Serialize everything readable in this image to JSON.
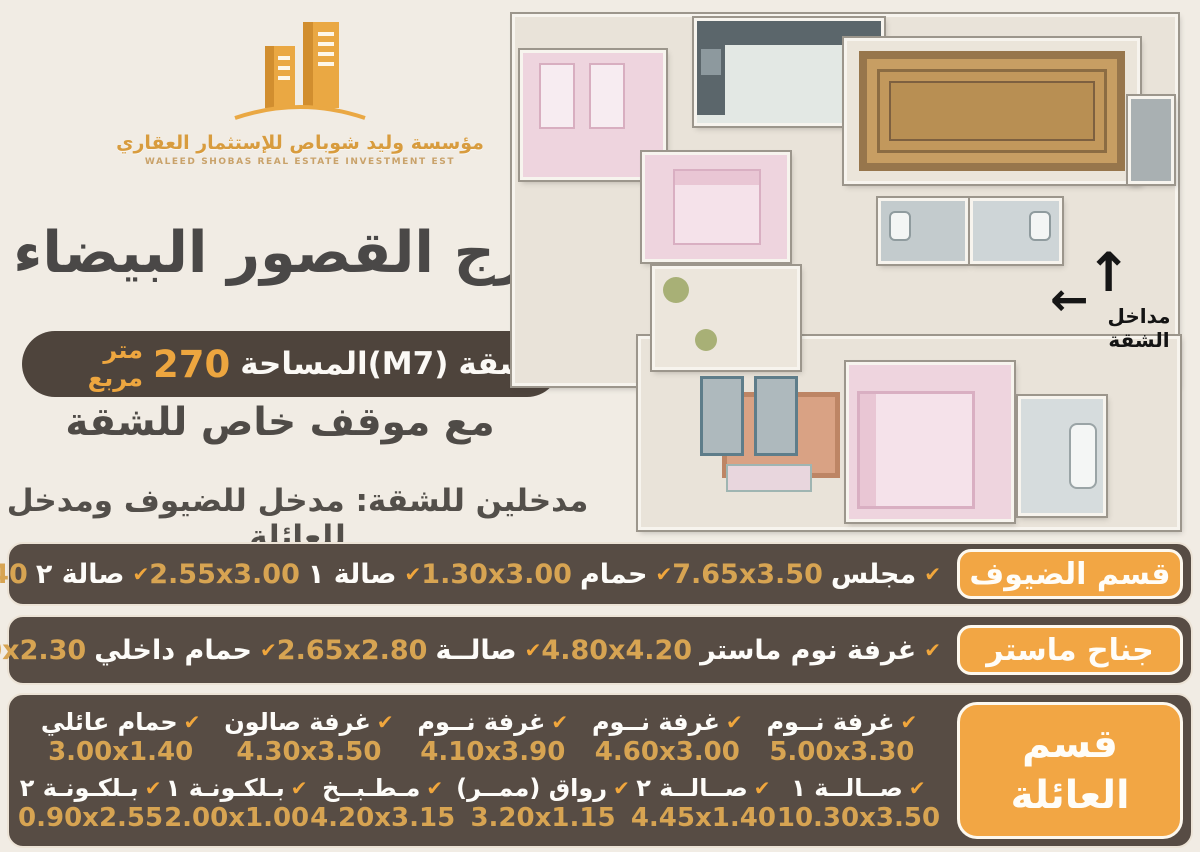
{
  "brand": {
    "name_ar": "مؤسسة وليد شوباص للإستثمار العقاري",
    "name_en": "WALEED SHOBAS REAL ESTATE INVESTMENT EST"
  },
  "header": {
    "title": "برج القصور البيضاء",
    "apartment_label": "شقة",
    "apartment_code": "(M7)",
    "area_label": "المساحة",
    "area_value": "270",
    "area_unit": "متر مربع",
    "parking_note": "مع موقف خاص للشقة",
    "entrances_note": "مدخلين للشقة: مدخل للضيوف ومدخل للعائلة"
  },
  "floor_plan": {
    "entrance_label": "مداخل الشقة"
  },
  "icons": {
    "check": "✔",
    "arrow_up": "↑",
    "arrow_left": "←"
  },
  "colors": {
    "accent_orange": "#f2a644",
    "gold_text": "#d7a452",
    "panel_brown": "#574c44",
    "dark_pill": "#4e443c",
    "title_gray": "#4a4847",
    "page_bg": "#f1ece4"
  },
  "sections": [
    {
      "label": "قسم الضيوف",
      "items": [
        {
          "label": "مجلس",
          "dim": "7.65x3.50"
        },
        {
          "label": "حمام",
          "dim": "1.30x3.00"
        },
        {
          "label": "صالة ١",
          "dim": "2.55x3.00"
        },
        {
          "label": "صالة ٢",
          "dim": "2.25x1.40"
        }
      ]
    },
    {
      "label": "جناح ماستر",
      "items": [
        {
          "label": "غرفة نوم ماستر",
          "dim": "4.80x4.20"
        },
        {
          "label": "صالــة",
          "dim": "2.65x2.80"
        },
        {
          "label": "حمام داخلي",
          "dim": "1.40x2.30"
        }
      ]
    },
    {
      "label": "قسم العائلة",
      "label_lines": [
        "قسم",
        "العائلة"
      ],
      "rows": [
        [
          {
            "label": "غرفة نــوم",
            "dim": "5.00x3.30"
          },
          {
            "label": "غرفة نــوم",
            "dim": "4.60x3.00"
          },
          {
            "label": "غرفة نــوم",
            "dim": "4.10x3.90"
          },
          {
            "label": "غرفة صالون",
            "dim": "4.30x3.50"
          },
          {
            "label": "حمام عائلي",
            "dim": "3.00x1.40"
          }
        ],
        [
          {
            "label": "صــالــة ١",
            "dim": "10.30x3.50"
          },
          {
            "label": "صــالــة ٢",
            "dim": "4.45x1.40"
          },
          {
            "label": "رواق (ممــر)",
            "dim": "3.20x1.15"
          },
          {
            "label": "مـطـبــخ",
            "dim": "4.20x3.15"
          },
          {
            "label": "بـلكـونـة ١",
            "dim": "2.00x1.00"
          },
          {
            "label": "بـلكـونـة ٢",
            "dim": "0.90x2.55"
          }
        ]
      ]
    }
  ]
}
